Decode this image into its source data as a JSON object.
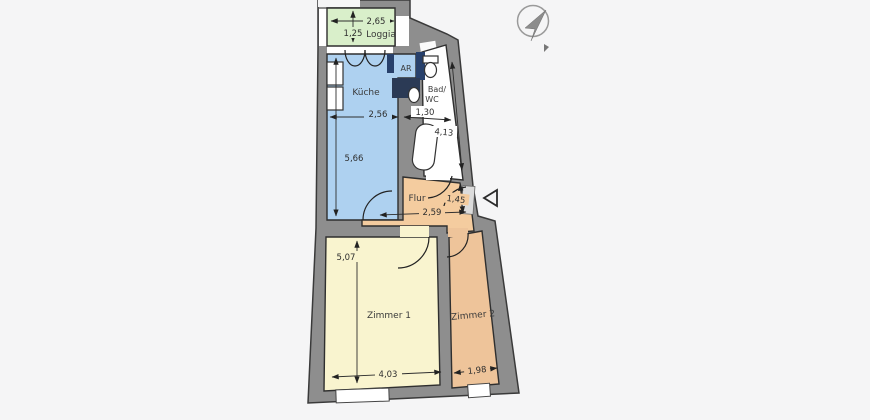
{
  "plan": {
    "background": "#f5f5f6",
    "wall_color": "#8e8e8e",
    "outline_color": "#3a3a3a",
    "cabinet_color": "#27406b",
    "rooms": {
      "loggia": {
        "label": "Loggia",
        "color": "#d9efca",
        "width": "2,65",
        "depth": "1,25"
      },
      "kueche": {
        "label": "Küche",
        "color": "#aed1f0",
        "width": "2,56",
        "depth": "5,66"
      },
      "ar": {
        "label": "AR",
        "color": "#aed1f0"
      },
      "bad": {
        "label_line1": "Bad/",
        "label_line2": "WC",
        "color": "#ffffff",
        "width": "1,30",
        "depth": "4,13"
      },
      "flur": {
        "label": "Flur",
        "color": "#f4cc9f",
        "width": "2,59",
        "depth": "1,45"
      },
      "zimmer1": {
        "label": "Zimmer 1",
        "color": "#f9f4cf",
        "width": "4,03",
        "depth": "5,07"
      },
      "zimmer2": {
        "label": "Zimmer 2",
        "color": "#eec49a",
        "width": "1,98"
      }
    },
    "icons": {
      "north_arrow": "compass-needle-icon",
      "entrance_marker": "entrance-triangle-icon"
    }
  }
}
